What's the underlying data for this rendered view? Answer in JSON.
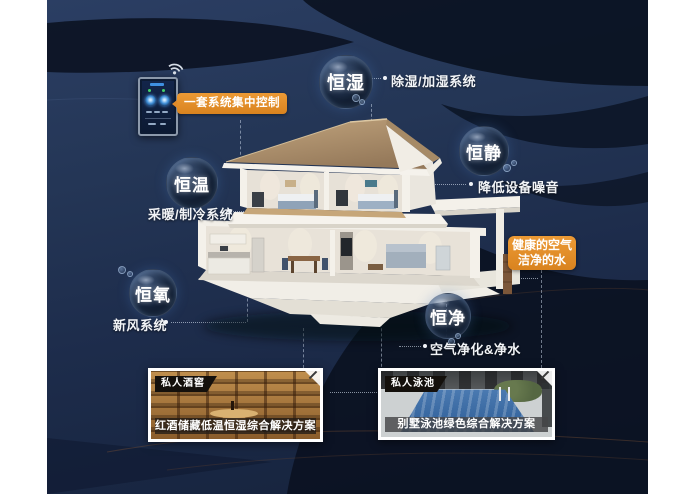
{
  "poster": {
    "control_panel": {
      "badge": "一套系统集中控制",
      "device": "smart home wall control panel"
    },
    "bubbles": [
      {
        "label": "恒湿",
        "desc": "除湿/加湿系统"
      },
      {
        "label": "恒静",
        "desc": "降低设备噪音"
      },
      {
        "label": "恒温",
        "desc": "采暖/制冷系统"
      },
      {
        "label": "恒氧",
        "desc": "新风系统"
      },
      {
        "label": "恒净",
        "desc": "空气净化&净水"
      }
    ],
    "highlight": {
      "line1": "健康的空气",
      "line2": "洁净的水"
    },
    "cards": [
      {
        "tag": "私人酒窖",
        "caption": "红酒储藏低温恒湿综合解决方案"
      },
      {
        "tag": "私人泳池",
        "caption": "别墅泳池绿色综合解决方案"
      }
    ],
    "icons": {
      "wifi": "wifi-icon"
    },
    "colors": {
      "accent_orange": "#e0892a",
      "stage_navy": "#223351",
      "dark_band": "#0b1322",
      "label_text": "#f2f4f7"
    }
  }
}
